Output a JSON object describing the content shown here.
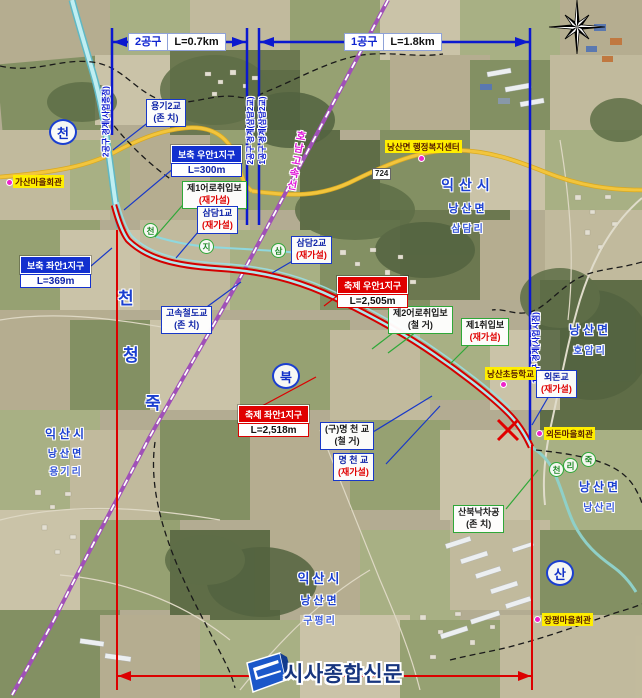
{
  "sections": {
    "sec2": {
      "label": "2공구",
      "length": "L=0.7km"
    },
    "sec1": {
      "label": "1공구",
      "length": "L=1.8km"
    }
  },
  "boundaries": {
    "left": "2공구 경계(사업종점)",
    "mid_left": "2공구 경계(삼담2교)",
    "mid_right": "1공구 경계(삼담2교)",
    "right": "1공구 경계(사업시점)"
  },
  "zones": {
    "bochuk_right": {
      "title": "보축 우안1지구",
      "length": "L=300m"
    },
    "bochuk_left": {
      "title": "보축 좌안1지구",
      "length": "L=369m"
    },
    "chukje_right": {
      "title": "축제 우안1지구",
      "length": "L=2,505m"
    },
    "chukje_left": {
      "title": "축제 좌안1지구",
      "length": "L=2,518m"
    }
  },
  "structures": {
    "yonggi2": {
      "name": "용기2교",
      "status": "(존 치)"
    },
    "fishway1": {
      "name": "제1어로취입보",
      "status": "(재가설)"
    },
    "samdam1": {
      "name": "삼담1교",
      "status": "(재가설)"
    },
    "samdam2": {
      "name": "삼담2교",
      "status": "(재가설)"
    },
    "ktx": {
      "name": "고속철도교",
      "status": "(존 치)"
    },
    "fishway2": {
      "name": "제2어로취입보",
      "status": "(철 거)"
    },
    "intake1": {
      "name": "제1취입보",
      "status": "(재가설)"
    },
    "oedon": {
      "name": "외돈교",
      "status": "(재가설)"
    },
    "old_myeongcheon": {
      "name": "(구)명 천 교",
      "status": "(철 거)"
    },
    "myeongcheon": {
      "name": "명 천 교",
      "status": "(재가설)"
    },
    "sanbuk_drop": {
      "name": "산북낙차공",
      "status": "(존 치)"
    }
  },
  "poi": {
    "gasan_hall": "가산마을회관",
    "nangsan_center": "낭산면 행정복지센터",
    "nangsan_school": "낭산초등학교",
    "oedon_hall": "외돈마을회관",
    "jangpyeong_hall": "장평마을회관"
  },
  "regions": {
    "samdam": {
      "city": "익산시",
      "myeon": "낭산면",
      "ri": "삼담리"
    },
    "hoam": {
      "myeon": "낭산면",
      "ri": "호암리"
    },
    "yonggi": {
      "city": "익산시",
      "myeon": "낭산면",
      "ri": "용기리"
    },
    "nangsan": {
      "myeon": "낭산면",
      "ri": "낭산리"
    },
    "gupyeong": {
      "city": "익산시",
      "myeon": "낭산면",
      "ri": "구평리"
    }
  },
  "stream_letters": {
    "jukcheong": [
      "천",
      "청",
      "죽"
    ],
    "sanbuk_circled": [
      "천",
      "북",
      "산"
    ],
    "green_upper": [
      "천",
      "지",
      "삼"
    ],
    "green_lower": [
      "천",
      "리",
      "죽"
    ]
  },
  "road_badge": "724",
  "railway_label": "호남고속선",
  "watermark": "시사종합신문",
  "colors": {
    "boundary_blue": "#0b18cf",
    "work_red": "#dc0000",
    "railway_magenta": "#d829d0",
    "road_yellow": "#f2c53d",
    "stream_cyan": "#8fd8de",
    "poi_yellow": "#ffee00",
    "region_blue": "#1b3fd0"
  }
}
